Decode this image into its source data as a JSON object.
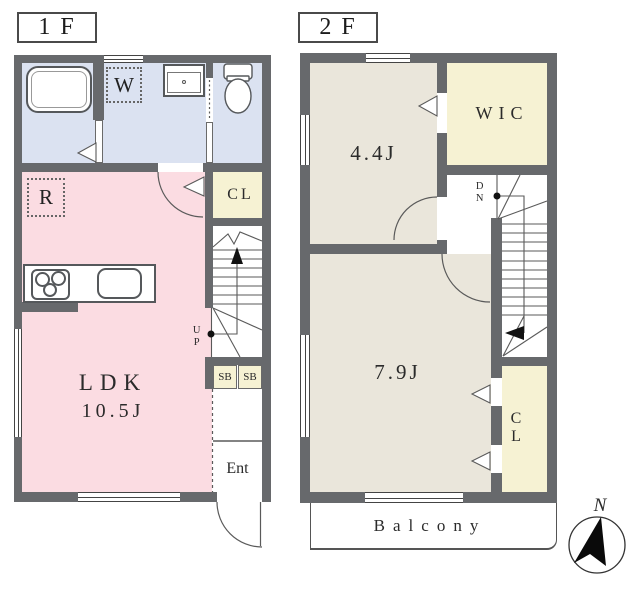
{
  "title": "2-story apartment floor plan",
  "floors": [
    {
      "label": "1F",
      "rooms": {
        "ldk": {
          "name": "LDK",
          "area": "10.5J"
        },
        "closet": "CL",
        "entrance": "Ent",
        "washer": "W",
        "fridge": "R",
        "shoebox1": "SB",
        "shoebox2": "SB",
        "stairs": "UP"
      }
    },
    {
      "label": "2F",
      "rooms": {
        "bedroom1": "4.4J",
        "wic": "WIC",
        "bedroom2": "7.9J",
        "closet": "CL",
        "stairs": "DN",
        "balcony": "Balcony"
      }
    }
  ],
  "compass": {
    "north": "N"
  },
  "colors": {
    "wall": "#67696c",
    "wet_area": "#dbe2f1",
    "ldk": "#fbdce2",
    "storage": "#f6f2d3",
    "bedroom": "#eae6db",
    "line": "#555555"
  }
}
